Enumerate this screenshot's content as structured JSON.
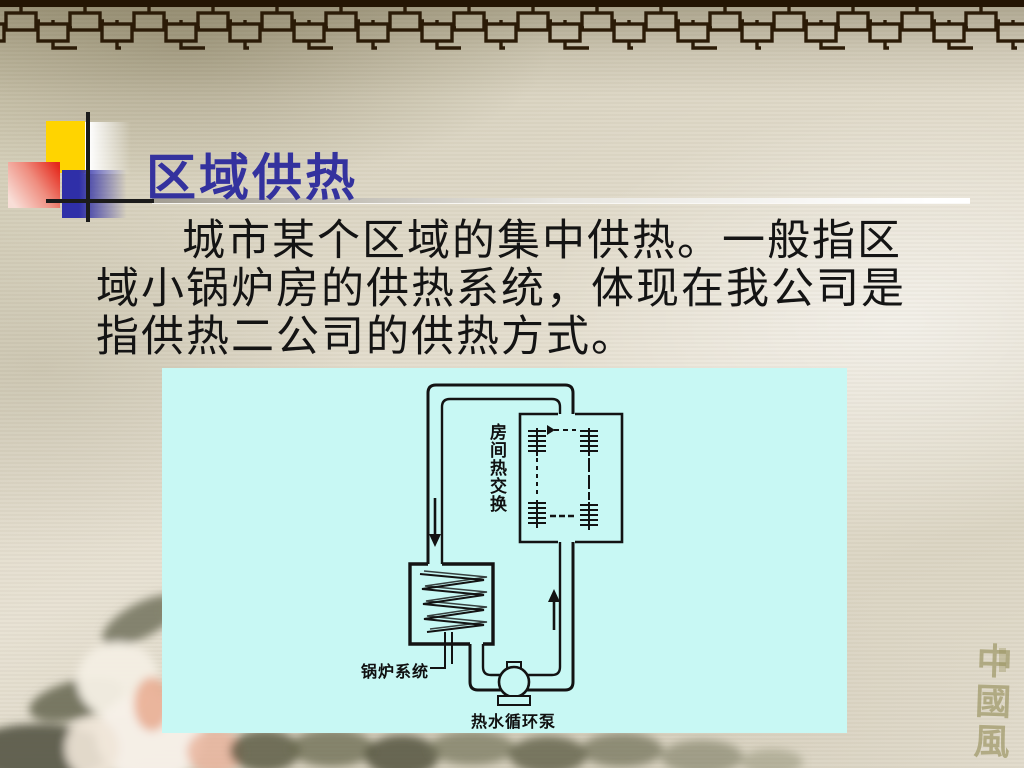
{
  "slide": {
    "title": "区域供热",
    "body_lines": [
      "城市某个区域的集中供热。一般指区",
      "域小锅炉房的供热系统，体现在我公司是",
      "指供热二公司的供热方式。"
    ]
  },
  "diagram": {
    "background_color": "#C8F8F4",
    "labels": {
      "heat_exchanger": "房间热交换",
      "boiler": "锅炉系统",
      "pump": "热水循环泵"
    }
  },
  "watermark": {
    "text": "中國風"
  },
  "colors": {
    "title": "#34329E",
    "accent_yellow": "#FFD400",
    "accent_red": "#E5281B",
    "accent_blue": "#2F2FA8",
    "lattice": "#2B1B07",
    "text": "#141414"
  }
}
